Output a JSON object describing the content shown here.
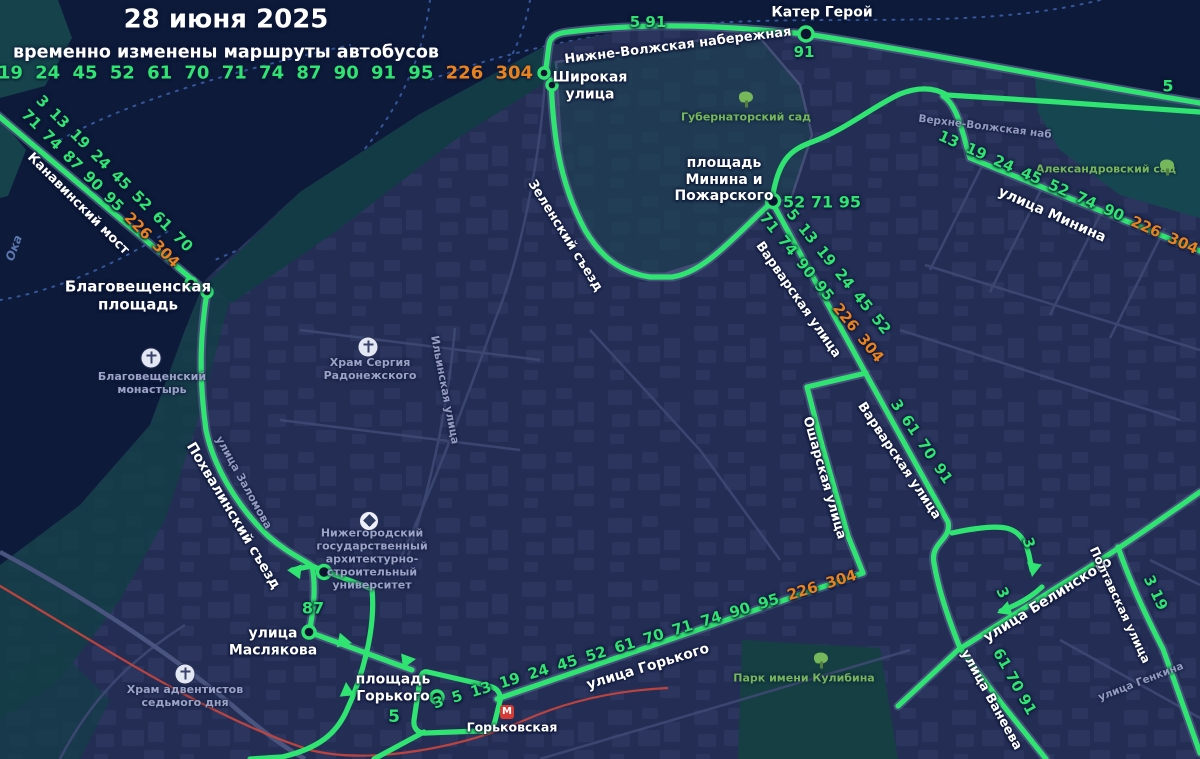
{
  "header": {
    "date": "28 июня 2025",
    "subtitle": "временно изменены маршруты автобусов",
    "routes_green": "3  5  13 19 24 45 52 61 70 71 74 87 90 91 95",
    "routes_orange": "226 304"
  },
  "colors": {
    "route_green": "#30e471",
    "route_orange": "#e8821e",
    "metro_red": "#c4443d",
    "water": "#0d1a39",
    "land": "#242e55"
  },
  "metro_station": {
    "letter": "М",
    "name": "Горьковская"
  },
  "map_labels": [
    {
      "name": "label-kater-geroy",
      "text": "Катер Герой",
      "x": 822,
      "y": 13,
      "rot": 0,
      "cls": "street-white",
      "size": 14
    },
    {
      "name": "route-num-5-91",
      "text": "5 91",
      "x": 648,
      "y": 23,
      "rot": 0,
      "cls": "num",
      "size": 15
    },
    {
      "name": "route-num-91",
      "text": "91",
      "x": 804,
      "y": 53,
      "rot": 0,
      "cls": "num",
      "size": 15
    },
    {
      "name": "label-nizhnevolzhskaya",
      "text": "Нижне-Волжская набережная",
      "x": 678,
      "y": 46,
      "rot": -7,
      "cls": "street-white",
      "size": 13
    },
    {
      "name": "label-shirokaya",
      "lines": [
        "Широкая",
        "улица"
      ],
      "x": 590,
      "y": 86,
      "rot": 0,
      "cls": "street-white",
      "size": 14
    },
    {
      "name": "route-num-5-top-right",
      "text": "5",
      "x": 1168,
      "y": 87,
      "rot": 0,
      "cls": "num",
      "size": 16
    },
    {
      "name": "label-verhnevolzhskaya",
      "text": "Верхне-Волжская наб",
      "x": 985,
      "y": 127,
      "rot": 7,
      "cls": "street-grey",
      "size": 10.5
    },
    {
      "name": "label-alexandrovsky-sad",
      "text": "Александровский сад",
      "x": 1106,
      "y": 170,
      "rot": 0,
      "cls": "poi-green"
    },
    {
      "name": "label-gubernatorsky-sad",
      "text": "Губернаторский сад",
      "x": 746,
      "y": 118,
      "rot": 0,
      "cls": "poi-green"
    },
    {
      "name": "label-pl-minina",
      "lines": [
        "площадь",
        "Минина и",
        "Пожарского"
      ],
      "x": 724,
      "y": 180,
      "rot": 0,
      "cls": "street-white",
      "size": 14
    },
    {
      "name": "route-num-52-71-95",
      "text": "52 71 95",
      "x": 822,
      "y": 203,
      "rot": 0,
      "cls": "num",
      "size": 16
    },
    {
      "name": "route-nums-minina",
      "green": "13 19 24 45 52 74 90",
      "orange": "226 304",
      "x": 1068,
      "y": 193,
      "rot": 24,
      "cls": "num",
      "size": 15,
      "ws": 4
    },
    {
      "name": "label-ul-minina",
      "text": "улица Минина",
      "x": 1052,
      "y": 215,
      "rot": 24,
      "cls": "street-white",
      "size": 14
    },
    {
      "name": "route-nums-kanavinsky-1",
      "text": "3 13 19 24 45 52 61 70",
      "x": 114,
      "y": 174,
      "rot": 45,
      "cls": "num",
      "size": 15,
      "ws": 3
    },
    {
      "name": "route-nums-kanavinsky-2",
      "green": "71 74 87 90 95",
      "orange": "226 304",
      "x": 100,
      "y": 189,
      "rot": 45,
      "cls": "num",
      "size": 15,
      "ws": 3
    },
    {
      "name": "label-kanavinsky-most",
      "text": "Канавинский мост",
      "x": 78,
      "y": 204,
      "rot": 45,
      "cls": "street-white",
      "size": 13
    },
    {
      "name": "label-oka",
      "text": "Ока",
      "x": 14,
      "y": 248,
      "rot": -70,
      "cls": "water"
    },
    {
      "name": "label-blagoveshchenskaya-pl",
      "lines": [
        "Благовещенская",
        "площадь"
      ],
      "x": 138,
      "y": 296,
      "rot": 0,
      "cls": "street-white",
      "size": 15
    },
    {
      "name": "label-blagoveshchensky-monastery",
      "lines": [
        "Благовещенский",
        "монастырь"
      ],
      "x": 152,
      "y": 384,
      "rot": 0,
      "cls": "poi-grey"
    },
    {
      "name": "label-hram-sergiya",
      "lines": [
        "Храм Сергия",
        "Радонежского"
      ],
      "x": 370,
      "y": 370,
      "rot": 0,
      "cls": "poi-grey"
    },
    {
      "name": "label-zelensky-syezd",
      "text": "Зеленский съезд",
      "x": 565,
      "y": 236,
      "rot": 58,
      "cls": "street-white",
      "size": 13
    },
    {
      "name": "label-ilyinskaya",
      "text": "Ильинская улица",
      "x": 444,
      "y": 390,
      "rot": 79,
      "cls": "street-grey"
    },
    {
      "name": "label-zalomova",
      "text": "улица Заломова",
      "x": 243,
      "y": 483,
      "rot": 61,
      "cls": "street-grey"
    },
    {
      "name": "label-pohvalinsky",
      "text": "Похвалинский съезд",
      "x": 233,
      "y": 516,
      "rot": 59,
      "cls": "street-white",
      "size": 14
    },
    {
      "name": "label-university",
      "lines": [
        "Нижегородский",
        "государственный",
        "архитектурно-",
        "строительный",
        "университет"
      ],
      "x": 372,
      "y": 560,
      "rot": 0,
      "cls": "poi-grey"
    },
    {
      "name": "route-num-87",
      "text": "87",
      "x": 313,
      "y": 609,
      "rot": 0,
      "cls": "num",
      "size": 16
    },
    {
      "name": "label-maslyakova",
      "lines": [
        "улица",
        "Маслякова"
      ],
      "x": 273,
      "y": 642,
      "rot": 0,
      "cls": "street-white",
      "size": 14
    },
    {
      "name": "label-pl-gorkogo",
      "lines": [
        "площадь",
        "Горького"
      ],
      "x": 393,
      "y": 688,
      "rot": 0,
      "cls": "street-white",
      "size": 14
    },
    {
      "name": "route-num-5-gorkogo",
      "text": "5",
      "x": 394,
      "y": 717,
      "rot": 0,
      "cls": "num",
      "size": 17
    },
    {
      "name": "label-gorkovskaya-metro",
      "text": "Горьковская",
      "x": 512,
      "y": 728,
      "rot": 0,
      "cls": "street-white",
      "size": 12.5
    },
    {
      "name": "route-nums-gorkogo",
      "green": "3 5 13 19 24 45 52 61 70 71 74 90 95",
      "orange": "226 304",
      "x": 645,
      "y": 640,
      "rot": -17,
      "cls": "num",
      "size": 15,
      "ws": 4
    },
    {
      "name": "label-ul-gorkogo",
      "text": "улица Горького",
      "x": 648,
      "y": 667,
      "rot": -17,
      "cls": "street-white",
      "size": 14
    },
    {
      "name": "label-park-kulibina",
      "text": "Парк имени Кулибина",
      "x": 804,
      "y": 679,
      "rot": 0,
      "cls": "poi-green"
    },
    {
      "name": "route-nums-varvarskaya-1",
      "text": "5 13 19 24 45 52",
      "x": 838,
      "y": 272,
      "rot": 51,
      "cls": "num",
      "size": 15,
      "ws": 3
    },
    {
      "name": "route-nums-varvarskaya-2",
      "green": "71 74 90 95",
      "orange": "226 304",
      "x": 821,
      "y": 288,
      "rot": 51,
      "cls": "num",
      "size": 15,
      "ws": 3
    },
    {
      "name": "label-varvarskaya-1",
      "text": "Варварская улица",
      "x": 798,
      "y": 300,
      "rot": 55,
      "cls": "street-white",
      "size": 13
    },
    {
      "name": "label-varvarskaya-2",
      "text": "Варварская улица",
      "x": 899,
      "y": 461,
      "rot": 56,
      "cls": "street-white",
      "size": 13
    },
    {
      "name": "route-nums-3-61-70-91",
      "text": "3 61 70 91",
      "x": 921,
      "y": 442,
      "rot": 56,
      "cls": "num",
      "size": 15,
      "ws": 3
    },
    {
      "name": "label-osharskaya",
      "text": "Ошарская улица",
      "x": 824,
      "y": 478,
      "rot": 74,
      "cls": "street-white",
      "size": 13
    },
    {
      "name": "label-belinskogo",
      "text": "улица Белинского",
      "x": 1048,
      "y": 600,
      "rot": -32,
      "cls": "street-white",
      "size": 14
    },
    {
      "name": "label-poltavskaya",
      "text": "Полтавская улица",
      "x": 1120,
      "y": 605,
      "rot": 65,
      "cls": "street-white",
      "size": 12
    },
    {
      "name": "route-nums-3-19",
      "text": "3 19",
      "x": 1155,
      "y": 593,
      "rot": 65,
      "cls": "num",
      "size": 15
    },
    {
      "name": "route-num-3-a",
      "text": "3",
      "x": 1028,
      "y": 543,
      "rot": 72,
      "cls": "num",
      "size": 15
    },
    {
      "name": "route-num-3-b",
      "text": "3",
      "x": 1002,
      "y": 593,
      "rot": 65,
      "cls": "num",
      "size": 15
    },
    {
      "name": "label-vaneeva",
      "text": "улица Ванеева",
      "x": 991,
      "y": 700,
      "rot": 61,
      "cls": "street-white",
      "size": 13
    },
    {
      "name": "route-nums-61-70-91",
      "text": "61 70 91",
      "x": 1014,
      "y": 682,
      "rot": 61,
      "cls": "num",
      "size": 15
    },
    {
      "name": "label-genkina",
      "text": "улица Генкина",
      "x": 1141,
      "y": 682,
      "rot": -21,
      "cls": "street-grey",
      "size": 10.5
    },
    {
      "name": "label-hram-adventistov",
      "lines": [
        "Храм адвентистов",
        "седьмого дня"
      ],
      "x": 185,
      "y": 697,
      "rot": 0,
      "cls": "poi-grey"
    }
  ],
  "map_icons": [
    {
      "name": "tree-icon",
      "type": "tree",
      "x": 1167,
      "y": 168
    },
    {
      "name": "tree-icon",
      "type": "tree",
      "x": 746,
      "y": 100
    },
    {
      "name": "tree-icon",
      "type": "tree",
      "x": 821,
      "y": 661
    },
    {
      "name": "church-cross-icon",
      "type": "cross",
      "x": 151,
      "y": 358
    },
    {
      "name": "church-cross-icon",
      "type": "cross",
      "x": 368,
      "y": 347
    },
    {
      "name": "church-cross-icon",
      "type": "cross",
      "x": 185,
      "y": 674
    },
    {
      "name": "university-icon",
      "type": "grad",
      "x": 369,
      "y": 521
    },
    {
      "name": "metro-icon",
      "type": "metro",
      "x": 507,
      "y": 712,
      "text": "М"
    }
  ]
}
